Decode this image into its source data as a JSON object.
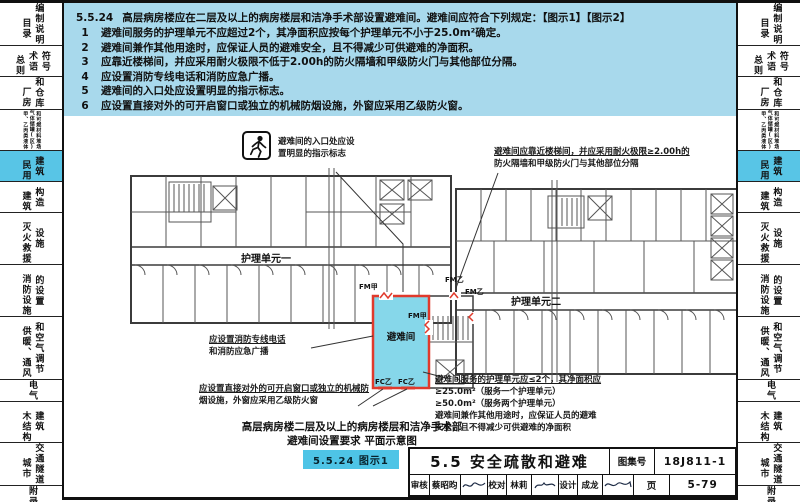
{
  "header": {
    "number": "5.5.24",
    "title": "高层病房楼应在二层及以上的病房楼层和洁净手术部设置避难间。避难间应符合下列规定：",
    "refs": "【图示1】【图示2】",
    "items": [
      {
        "num": "1",
        "text": "避难间服务的护理单元不应超过2个，其净面积应按每个护理单元不小于25.0m²确定。"
      },
      {
        "num": "2",
        "text": "避难间兼作其他用途时，应保证人员的避难安全，且不得减少可供避难的净面积。"
      },
      {
        "num": "3",
        "text": "应靠近楼梯间，并应采用耐火极限不低于2.00h的防火隔墙和甲级防火门与其他部位分隔。"
      },
      {
        "num": "4",
        "text": "应设置消防专线电话和消防应急广播。"
      },
      {
        "num": "5",
        "text": "避难间的入口处应设置明显的指示标志。"
      },
      {
        "num": "6",
        "text": "应设置直接对外的可开启窗口或独立的机械防烟设施，外窗应采用乙级防火窗。"
      }
    ]
  },
  "sidebar": {
    "tabs": [
      {
        "id": "catalog",
        "cols": [
          "目录",
          "编制说明"
        ]
      },
      {
        "id": "general-terms",
        "cols": [
          "总则",
          "术语",
          "符号"
        ]
      },
      {
        "id": "factory-warehouse",
        "cols": [
          "厂房",
          "和仓库"
        ]
      },
      {
        "id": "tanks-yards",
        "cols": [
          "甲、乙丙类液体",
          "气体储罐(区)",
          "和可燃材料堆场"
        ],
        "tiny": true
      },
      {
        "id": "civil-building",
        "cols": [
          "民用",
          "建筑"
        ],
        "active": true
      },
      {
        "id": "building-construction",
        "cols": [
          "建筑",
          "构造"
        ]
      },
      {
        "id": "rescue-facilities",
        "cols": [
          "灭火救援",
          "设施"
        ]
      },
      {
        "id": "fire-facility-setup",
        "cols": [
          "消防设施",
          "的设置"
        ]
      },
      {
        "id": "hvac",
        "cols": [
          "供暖、通风",
          "和空气调节"
        ]
      },
      {
        "id": "electrical",
        "cols": [
          "电气"
        ]
      },
      {
        "id": "timber-building",
        "cols": [
          "木结构",
          "建筑"
        ]
      },
      {
        "id": "urban-tunnel",
        "cols": [
          "城市",
          "交通隧道"
        ]
      },
      {
        "id": "appendix",
        "cols": [
          "附录"
        ]
      }
    ]
  },
  "diagram": {
    "labels": {
      "unit1": "护理单元一",
      "unit2": "护理单元二",
      "refuge": "避难间",
      "fm_jia": "FM甲",
      "fm_yi": "FM乙",
      "fc_yi": "FC乙"
    },
    "annotations": {
      "entrance": {
        "lines": [
          "避难间的入口处应设",
          "置明显的指示标志"
        ]
      },
      "stair": {
        "lines": [
          "避难间应靠近楼梯间，并应采用耐火极限≥2.00h的",
          "防火隔墙和甲级防火门与其他部位分隔"
        ]
      },
      "phone": {
        "lines": [
          "应设置消防专线电话",
          "和消防应急广播"
        ]
      },
      "window": {
        "lines": [
          "应设置直接对外的可开启窗口或独立的机械防",
          "烟设施，外窗应采用乙级防火窗"
        ]
      },
      "area": {
        "lines": [
          "避难间服务的护理单元应≤2个，其净面积应",
          "≥25.0m²（服务一个护理单元）",
          "≥50.0m²（服务两个护理单元）",
          "避难间兼作其他用途时，应保证人员的避难",
          "安全，且不得减少可供避难的净面积"
        ]
      }
    },
    "caption_lines": [
      "高层病房楼二层及以上的病房楼层和洁净手术部",
      "避难间设置要求 平面示意图"
    ],
    "figure_badge": "5.5.24 图示1",
    "colors": {
      "refuge_fill": "#86d7ea",
      "fire_door_red": "#e03a2c",
      "panel_blue": "#a8d9ec",
      "tab_active": "#58c5e6"
    }
  },
  "titleblock": {
    "section_title": "5.5 安全疏散和避难",
    "atlas_label": "图集号",
    "atlas_no": "18J811-1",
    "page_label": "页",
    "page_no": "5-79",
    "review_label": "审核",
    "reviewer": "蔡昭昀",
    "proof_label": "校对",
    "proofreader": "林莉",
    "design_label": "设计",
    "designer": "成龙"
  }
}
